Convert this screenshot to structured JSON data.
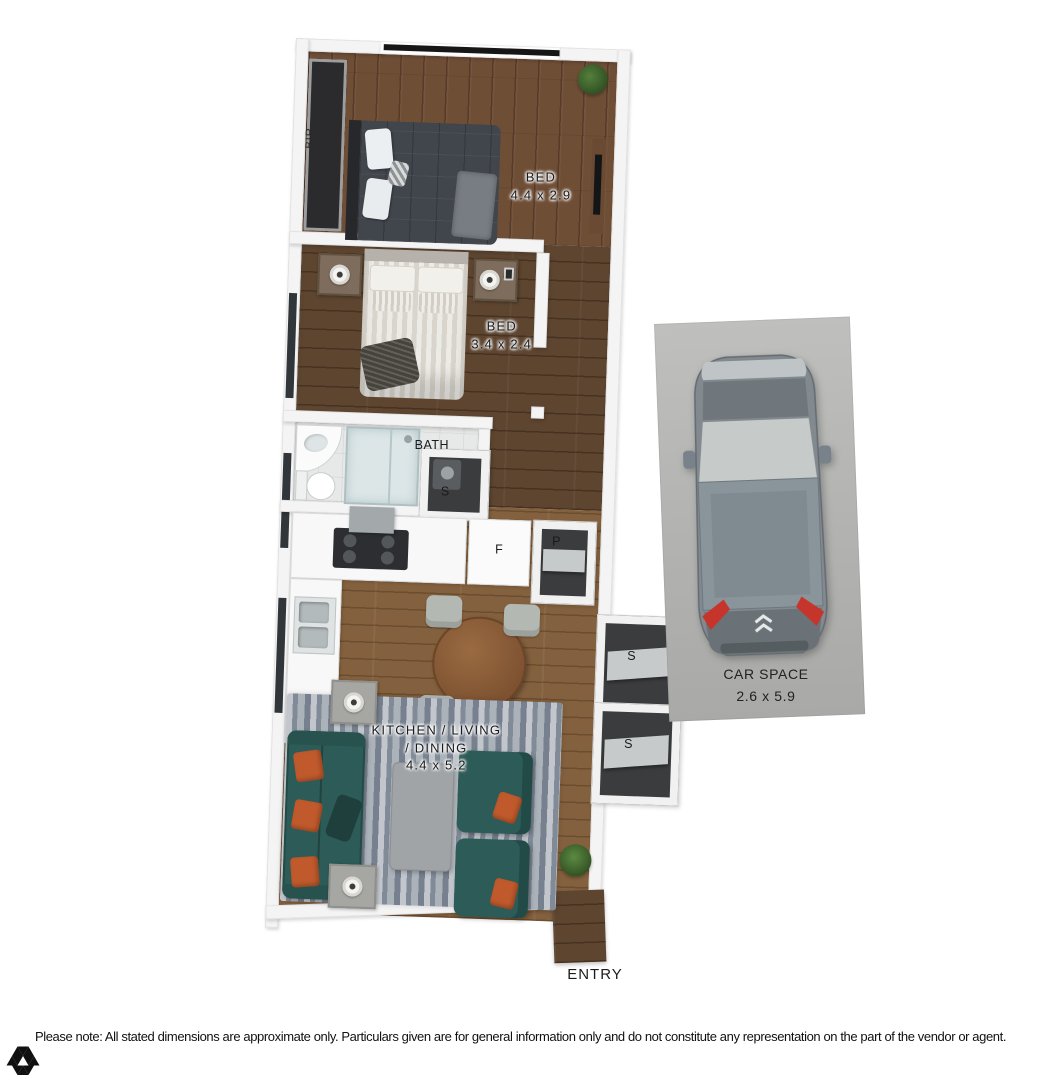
{
  "plan": {
    "entry_label": "ENTRY",
    "rooms": {
      "bed1": {
        "name": "BED",
        "dims": "4.4 x 2.9"
      },
      "bed2": {
        "name": "BED",
        "dims": "3.4 x 2.4"
      },
      "bath": {
        "name": "BATH"
      },
      "kld": {
        "line1": "KITCHEN / LIVING",
        "line2": "/ DINING",
        "dims": "4.4 x 5.2"
      },
      "car": {
        "name": "CAR SPACE",
        "dims": "2.6 x 5.9"
      }
    },
    "features": {
      "bir": "BIR",
      "bath_storage": "S",
      "fridge": "F",
      "pantry": "P",
      "storage_top": "S",
      "storage_bottom": "S"
    }
  },
  "footer": {
    "disclaimer": "Please note: All stated dimensions are approximate only. Particulars given are for general information only and do not constitute any representation on the part of the vendor or agent.",
    "logo_icon": "triangle-mosaic-logo"
  },
  "colors": {
    "floor_bed1": "#6f4e36",
    "floor_bed2": "#5d4530",
    "floor_living": "#84613e",
    "bath_tile": "#e7e9e9",
    "wall": "#f4f4f4",
    "sofa_teal": "#2d5b57",
    "pillow_orange": "#c05a2c",
    "rug_blue_grey": "#99a1ab",
    "car_grey": "#828a90",
    "concrete_grey": "#b5b5b3",
    "taillight_red": "#c6352b"
  }
}
